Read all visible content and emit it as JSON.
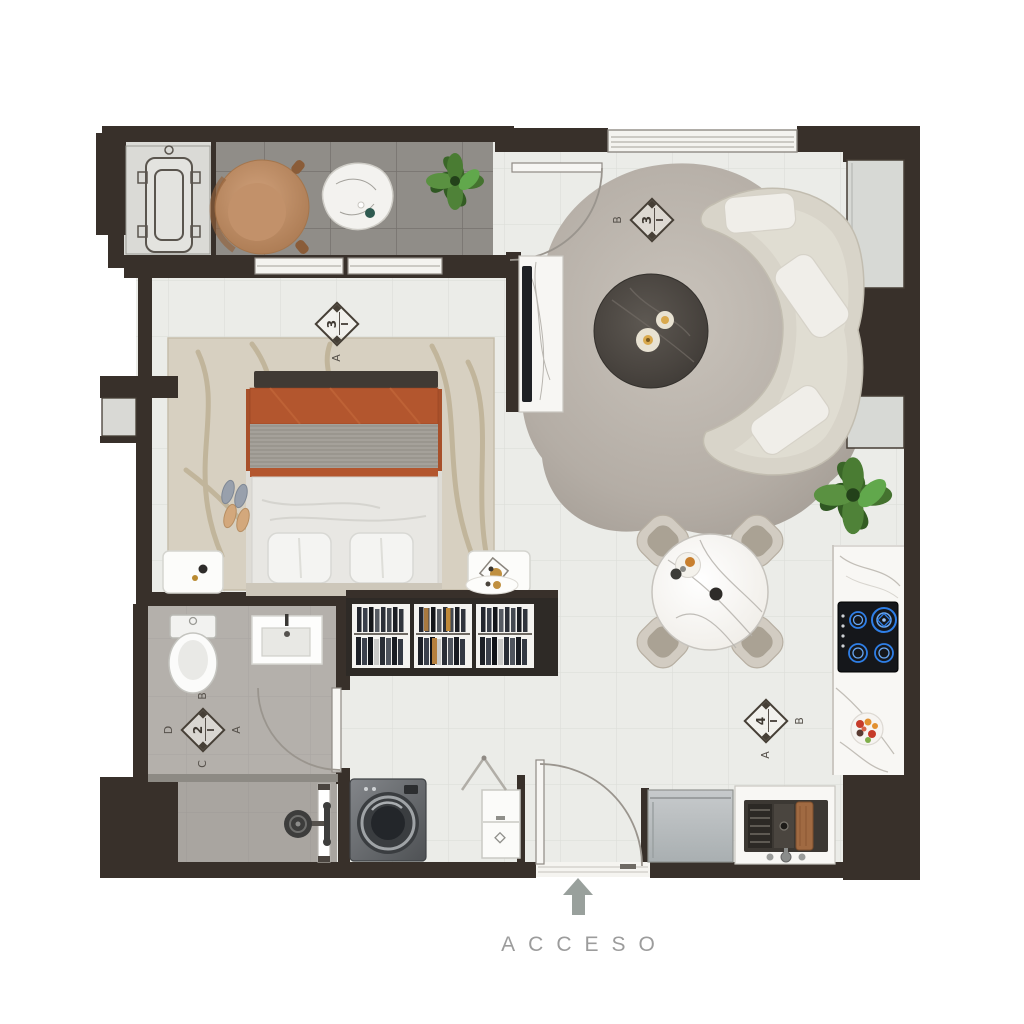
{
  "plan": {
    "access_label": "ACCESO",
    "markers": [
      {
        "id": "bedroom-window-marker",
        "number": "3",
        "letters": {
          "bottom": "A"
        }
      },
      {
        "id": "living-window-marker",
        "number": "3",
        "letters": {
          "left": "B"
        }
      },
      {
        "id": "bathroom-marker",
        "number": "2",
        "letters": {
          "top": "B",
          "right": "A",
          "bottom": "C",
          "left": "D"
        }
      },
      {
        "id": "dining-marker",
        "number": "4",
        "letters": {
          "bottom": "A",
          "right": "B"
        }
      }
    ],
    "colors": {
      "wall": "#38302a",
      "balcony_floor": "#908d88",
      "interior_floor": "#ebece8",
      "bathroom_floor": "#b4b0ab",
      "bedroom_rug": "#d7d0c1",
      "living_rug": "#b7b0a8",
      "sofa": "#d8d4c9",
      "blanket_accent": "#b0542c",
      "burner_blue": "#2e7fe8",
      "marble": "#f7f6f3",
      "access_text": "#9c9c9c"
    },
    "furniture_icons": [
      "air-conditioner",
      "lounge-chair",
      "side-table",
      "plant",
      "bed",
      "bench",
      "nightstand",
      "slippers",
      "wardrobe",
      "toilet",
      "vanity-sink",
      "shower",
      "washing-machine",
      "laundry-cabinet",
      "sofa",
      "coffee-table",
      "tv-console",
      "dining-table",
      "dining-chair",
      "cooktop",
      "fruit-bowl",
      "kitchen-sink",
      "refrigerator",
      "entry-door"
    ]
  }
}
